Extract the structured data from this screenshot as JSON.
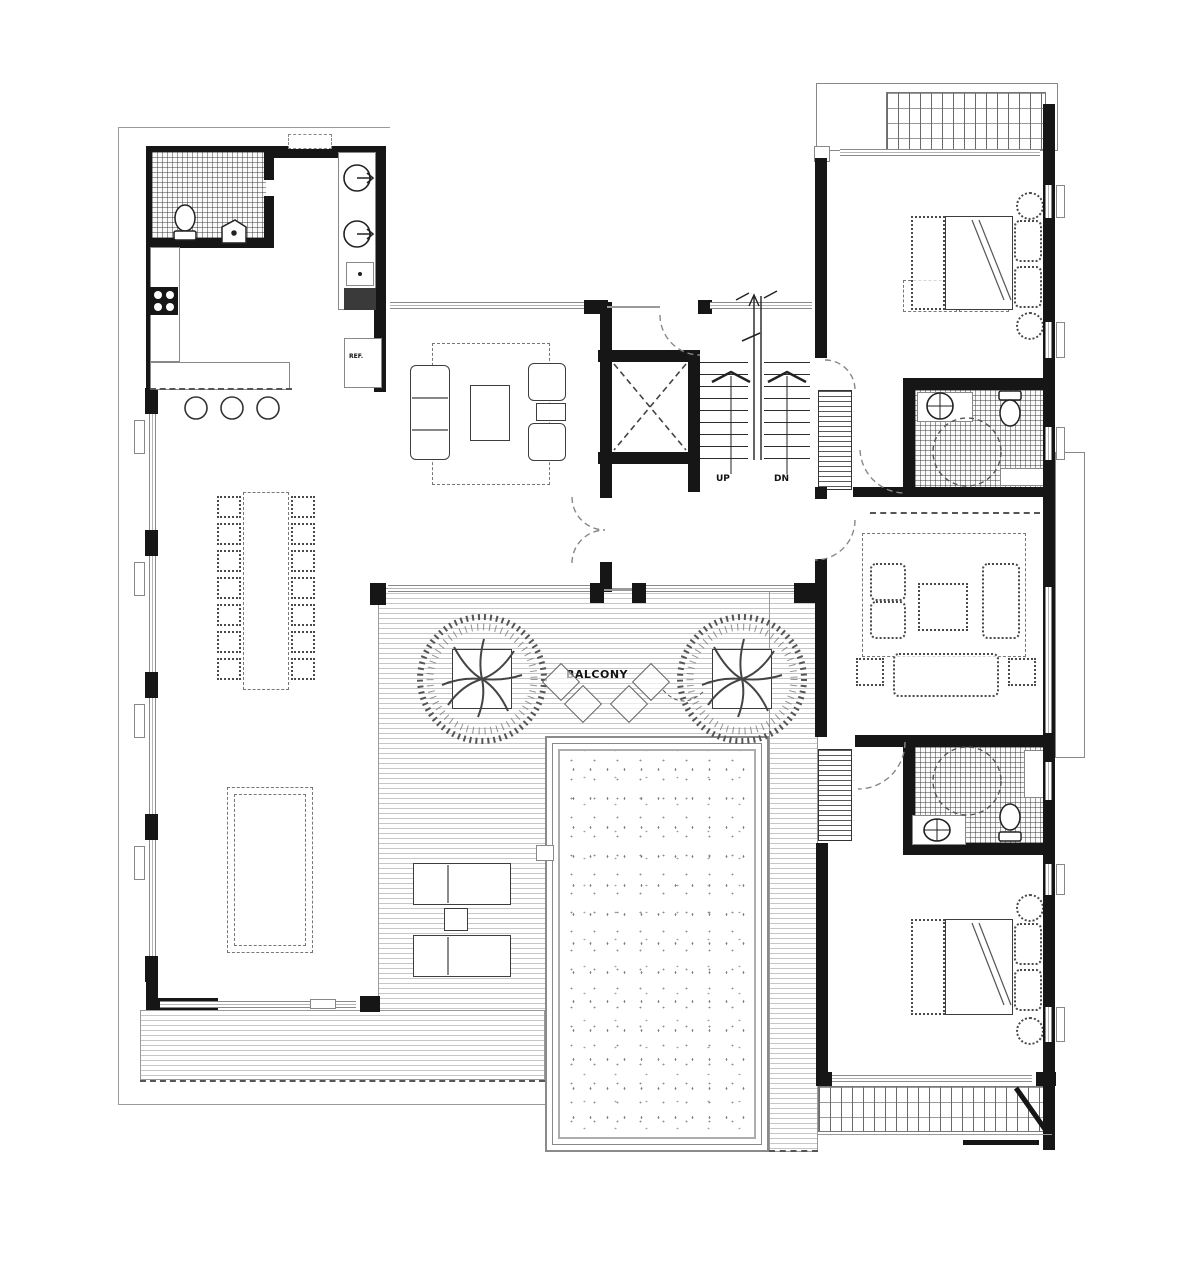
{
  "plan": {
    "labels": {
      "balcony": "BALCONY",
      "stairs_up": "UP",
      "stairs_down": "DN",
      "refrigerator": "REF."
    },
    "colors": {
      "wall": "#161616",
      "linework": "#8a8a8a",
      "deck_stripe": "#c7c7c7",
      "background": "#ffffff"
    },
    "icons": [
      "tree-icon",
      "elevator-x-icon",
      "door-arc-icon",
      "stair-arrow-icon",
      "toilet-icon",
      "sink-basin-icon",
      "shower-icon",
      "stove-burners-icon",
      "bed-icon",
      "sofa-icon",
      "dining-table-icon",
      "pool-icon",
      "lounge-chair-icon",
      "planter-icon"
    ]
  }
}
